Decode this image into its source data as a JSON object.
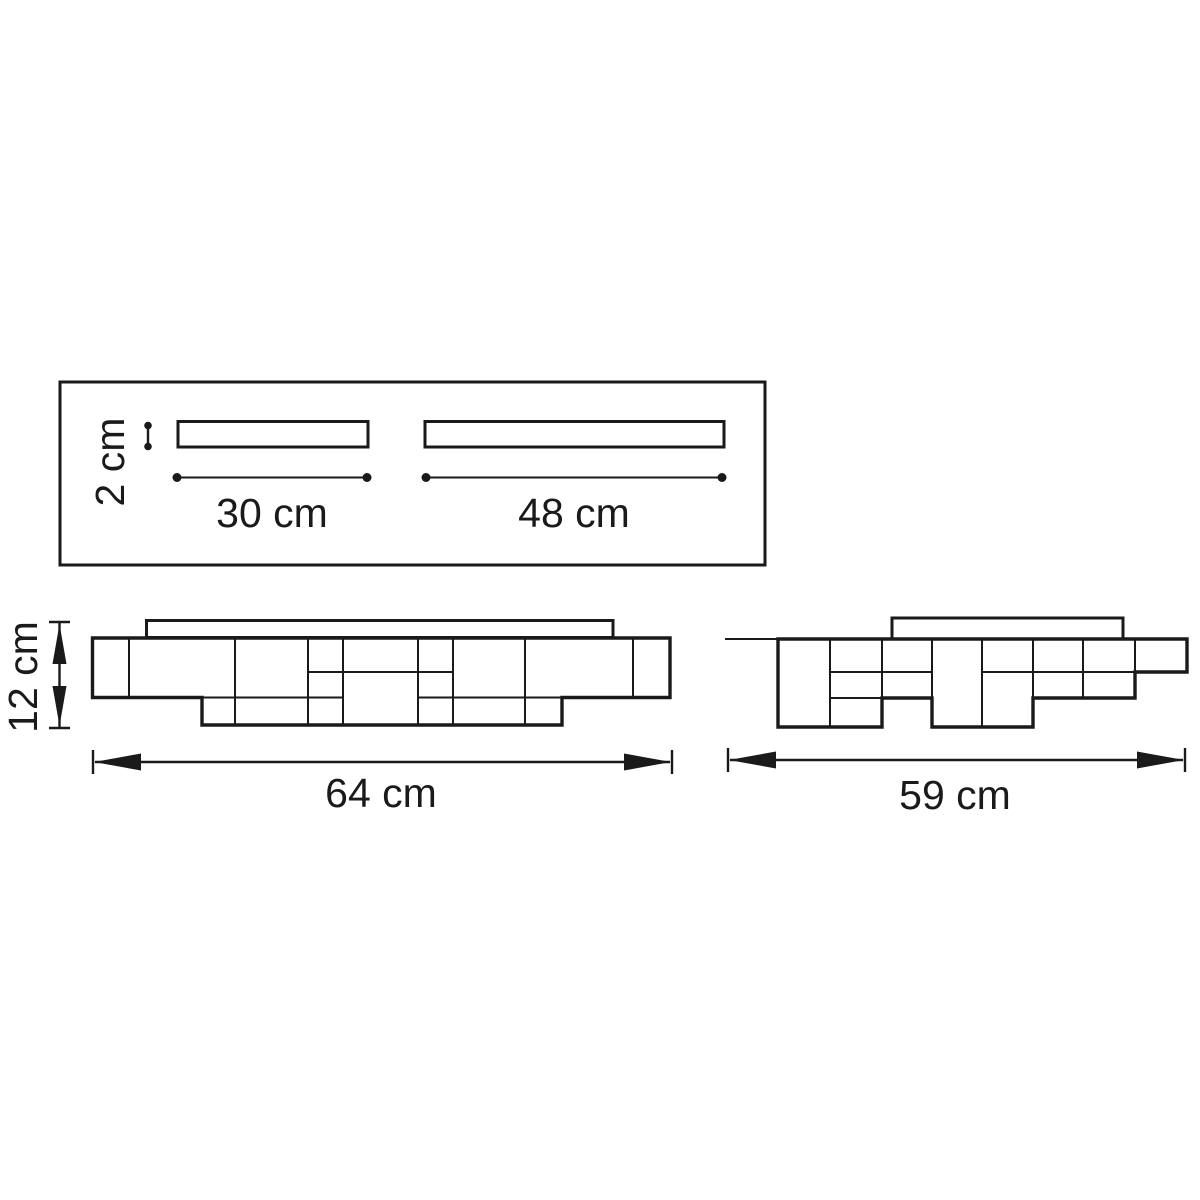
{
  "colors": {
    "background": "#ffffff",
    "line": "#1a1a1a",
    "text": "#1a1a1a"
  },
  "views": {
    "top": {
      "slot_height": "2 cm",
      "left_slot_length": "30 cm",
      "right_slot_length": "48 cm"
    },
    "front": {
      "height": "12 cm",
      "width": "64 cm"
    },
    "side": {
      "width": "59 cm"
    }
  }
}
